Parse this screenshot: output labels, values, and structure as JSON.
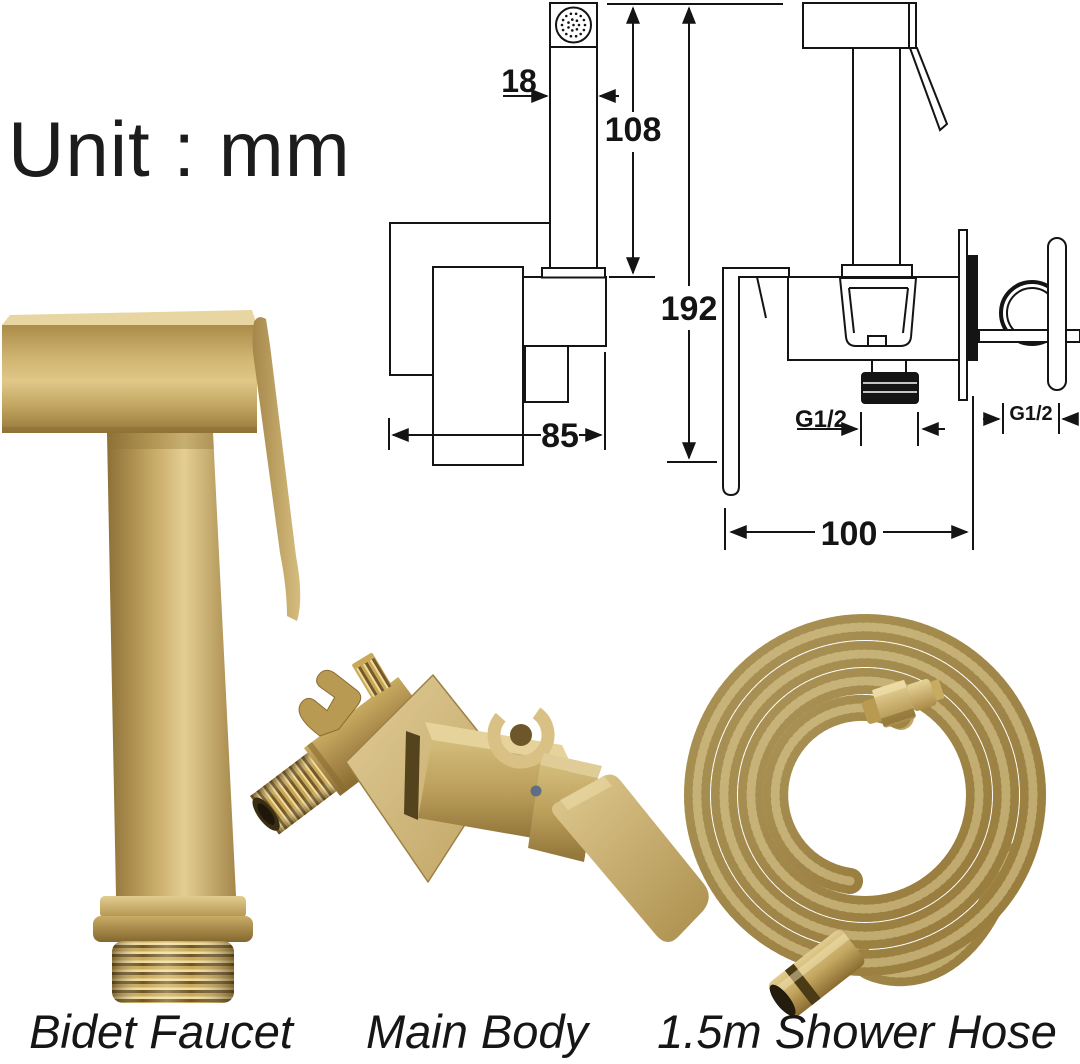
{
  "meta": {
    "unit_label": "Unit : mm"
  },
  "diagram": {
    "front_view": {
      "head_width": "18",
      "sprayer_height": "108",
      "total_height": "192",
      "body_width": "85"
    },
    "side_view": {
      "outlet_thread": "G1/2",
      "handle_thread": "G1/2",
      "depth": "100"
    }
  },
  "products": {
    "bidet_faucet": {
      "label": "Bidet Faucet"
    },
    "main_body": {
      "label": "Main Body"
    },
    "shower_hose": {
      "label": "1.5m Shower Hose"
    }
  },
  "colors": {
    "line": "#141414",
    "gold": "#c2a55e",
    "gold_light": "#e7d49c",
    "gold_dark": "#8f7336"
  }
}
